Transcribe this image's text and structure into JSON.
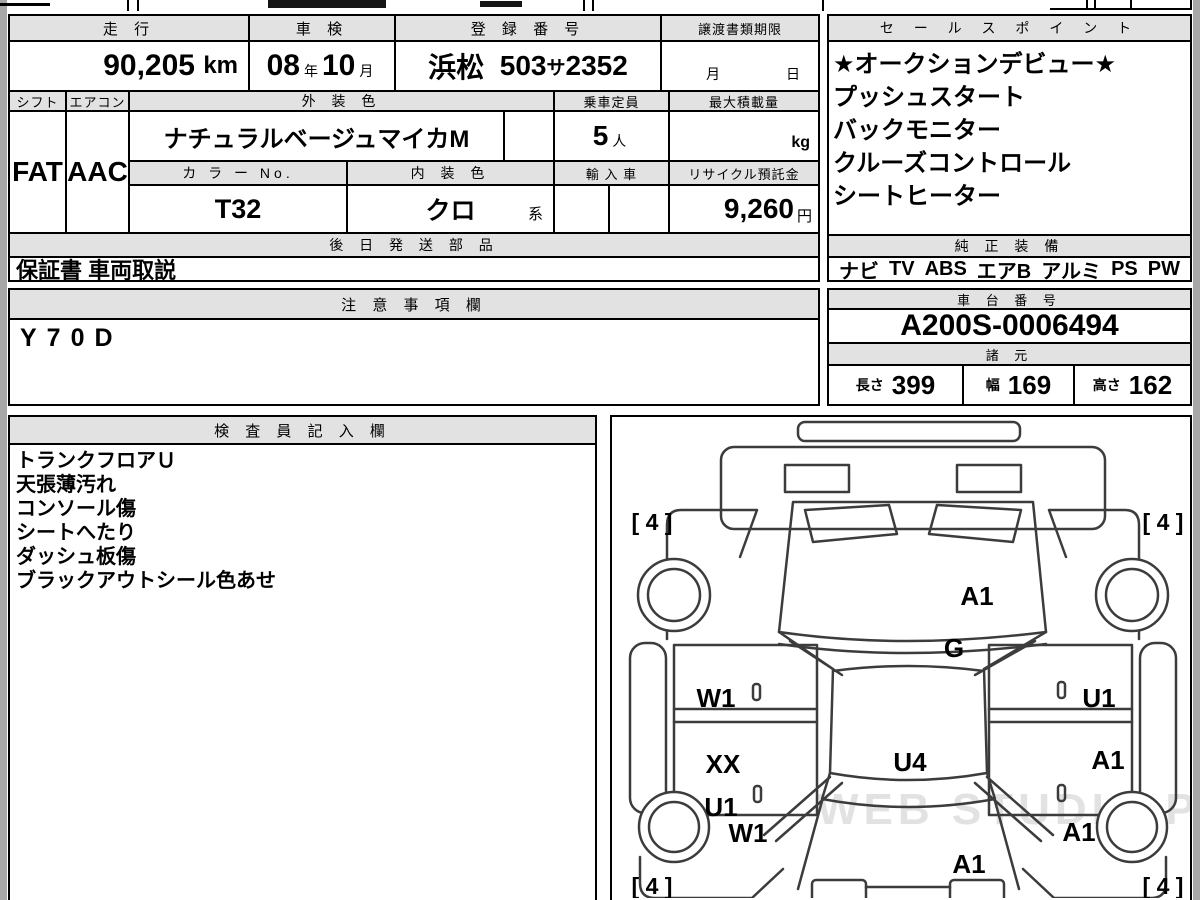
{
  "info": {
    "mileage": {
      "header": "走 行",
      "value": "90,205",
      "unit": "km"
    },
    "shaken": {
      "header": "車 検",
      "year": "08",
      "year_unit": "年",
      "month": "10",
      "month_unit": "月"
    },
    "registration": {
      "header": "登 録 番 号",
      "area": "浜松",
      "cls": "503",
      "kana": "サ",
      "number": "2352"
    },
    "transfer": {
      "header": "譲渡書類期限",
      "month_unit": "月",
      "day_unit": "日"
    },
    "shift": {
      "header": "シフト",
      "value": "FAT"
    },
    "aircon": {
      "header": "エアコン",
      "value": "AAC"
    },
    "exterior": {
      "header": "外 装 色",
      "value": "ナチュラルベージュマイカM"
    },
    "capacity": {
      "header": "乗車定員",
      "value": "5",
      "unit": "人"
    },
    "max_load": {
      "header": "最大積載量",
      "unit": "kg"
    },
    "color_no": {
      "header": "カ ラ ー No.",
      "value": "T32"
    },
    "interior": {
      "header": "内 装 色",
      "value": "クロ",
      "suffix": "系"
    },
    "import_car": {
      "header": "輸 入 車"
    },
    "recycle": {
      "header": "リサイクル預託金",
      "value": "9,260",
      "unit": "円"
    },
    "later_parts": {
      "header": "後 日 発 送 部 品",
      "value": "保証書 車両取説"
    }
  },
  "sales": {
    "header": "セ ー ル ス ポ イ ン ト",
    "items": [
      "★オークションデビュー★",
      "プッシュスタート",
      "バックモニター",
      "クルーズコントロール",
      "シートヒーター"
    ]
  },
  "equipment": {
    "header": "純 正 装 備",
    "items": [
      "ナビ",
      "TV",
      "ABS",
      "エアB",
      "アルミ",
      "PS",
      "PW"
    ]
  },
  "notes": {
    "header": "注 意 事 項 欄",
    "value": "Y70D"
  },
  "chassis": {
    "header": "車 台 番 号",
    "value": "A200S-0006494"
  },
  "specs": {
    "header": "諸 元",
    "dims": [
      {
        "label": "長さ",
        "value": "399"
      },
      {
        "label": "幅",
        "value": "169"
      },
      {
        "label": "高さ",
        "value": "162"
      }
    ]
  },
  "inspector": {
    "header": "検 査 員 記 入 欄",
    "items": [
      "トランクフロアＵ",
      "天張薄汚れ",
      "コンソール傷",
      "シートへたり",
      "ダッシュ板傷",
      "ブラックアウトシール色あせ"
    ]
  },
  "diagram": {
    "corner_marks": {
      "front_left": "[ 4 ]",
      "front_right": "[ 4 ]",
      "rear_left": "[ 4 ]",
      "rear_right": "[ 4 ]"
    },
    "marks": {
      "windshield": "A1",
      "cowl": "G",
      "front_left_door": "W1",
      "front_right_door": "U1",
      "rear_left_door_upper": "XX",
      "rear_left_door_lower": "U1",
      "roof": "U4",
      "rear_right_door": "A1",
      "rear_left_fender": "W1",
      "rear_right_fender": "A1",
      "rear_hatch": "A1"
    }
  },
  "watermark": "WEB STUDIO PRO",
  "colors": {
    "header_bg": "#e2e2e2",
    "border": "#000000",
    "page_margin": "#a8a8a8"
  }
}
